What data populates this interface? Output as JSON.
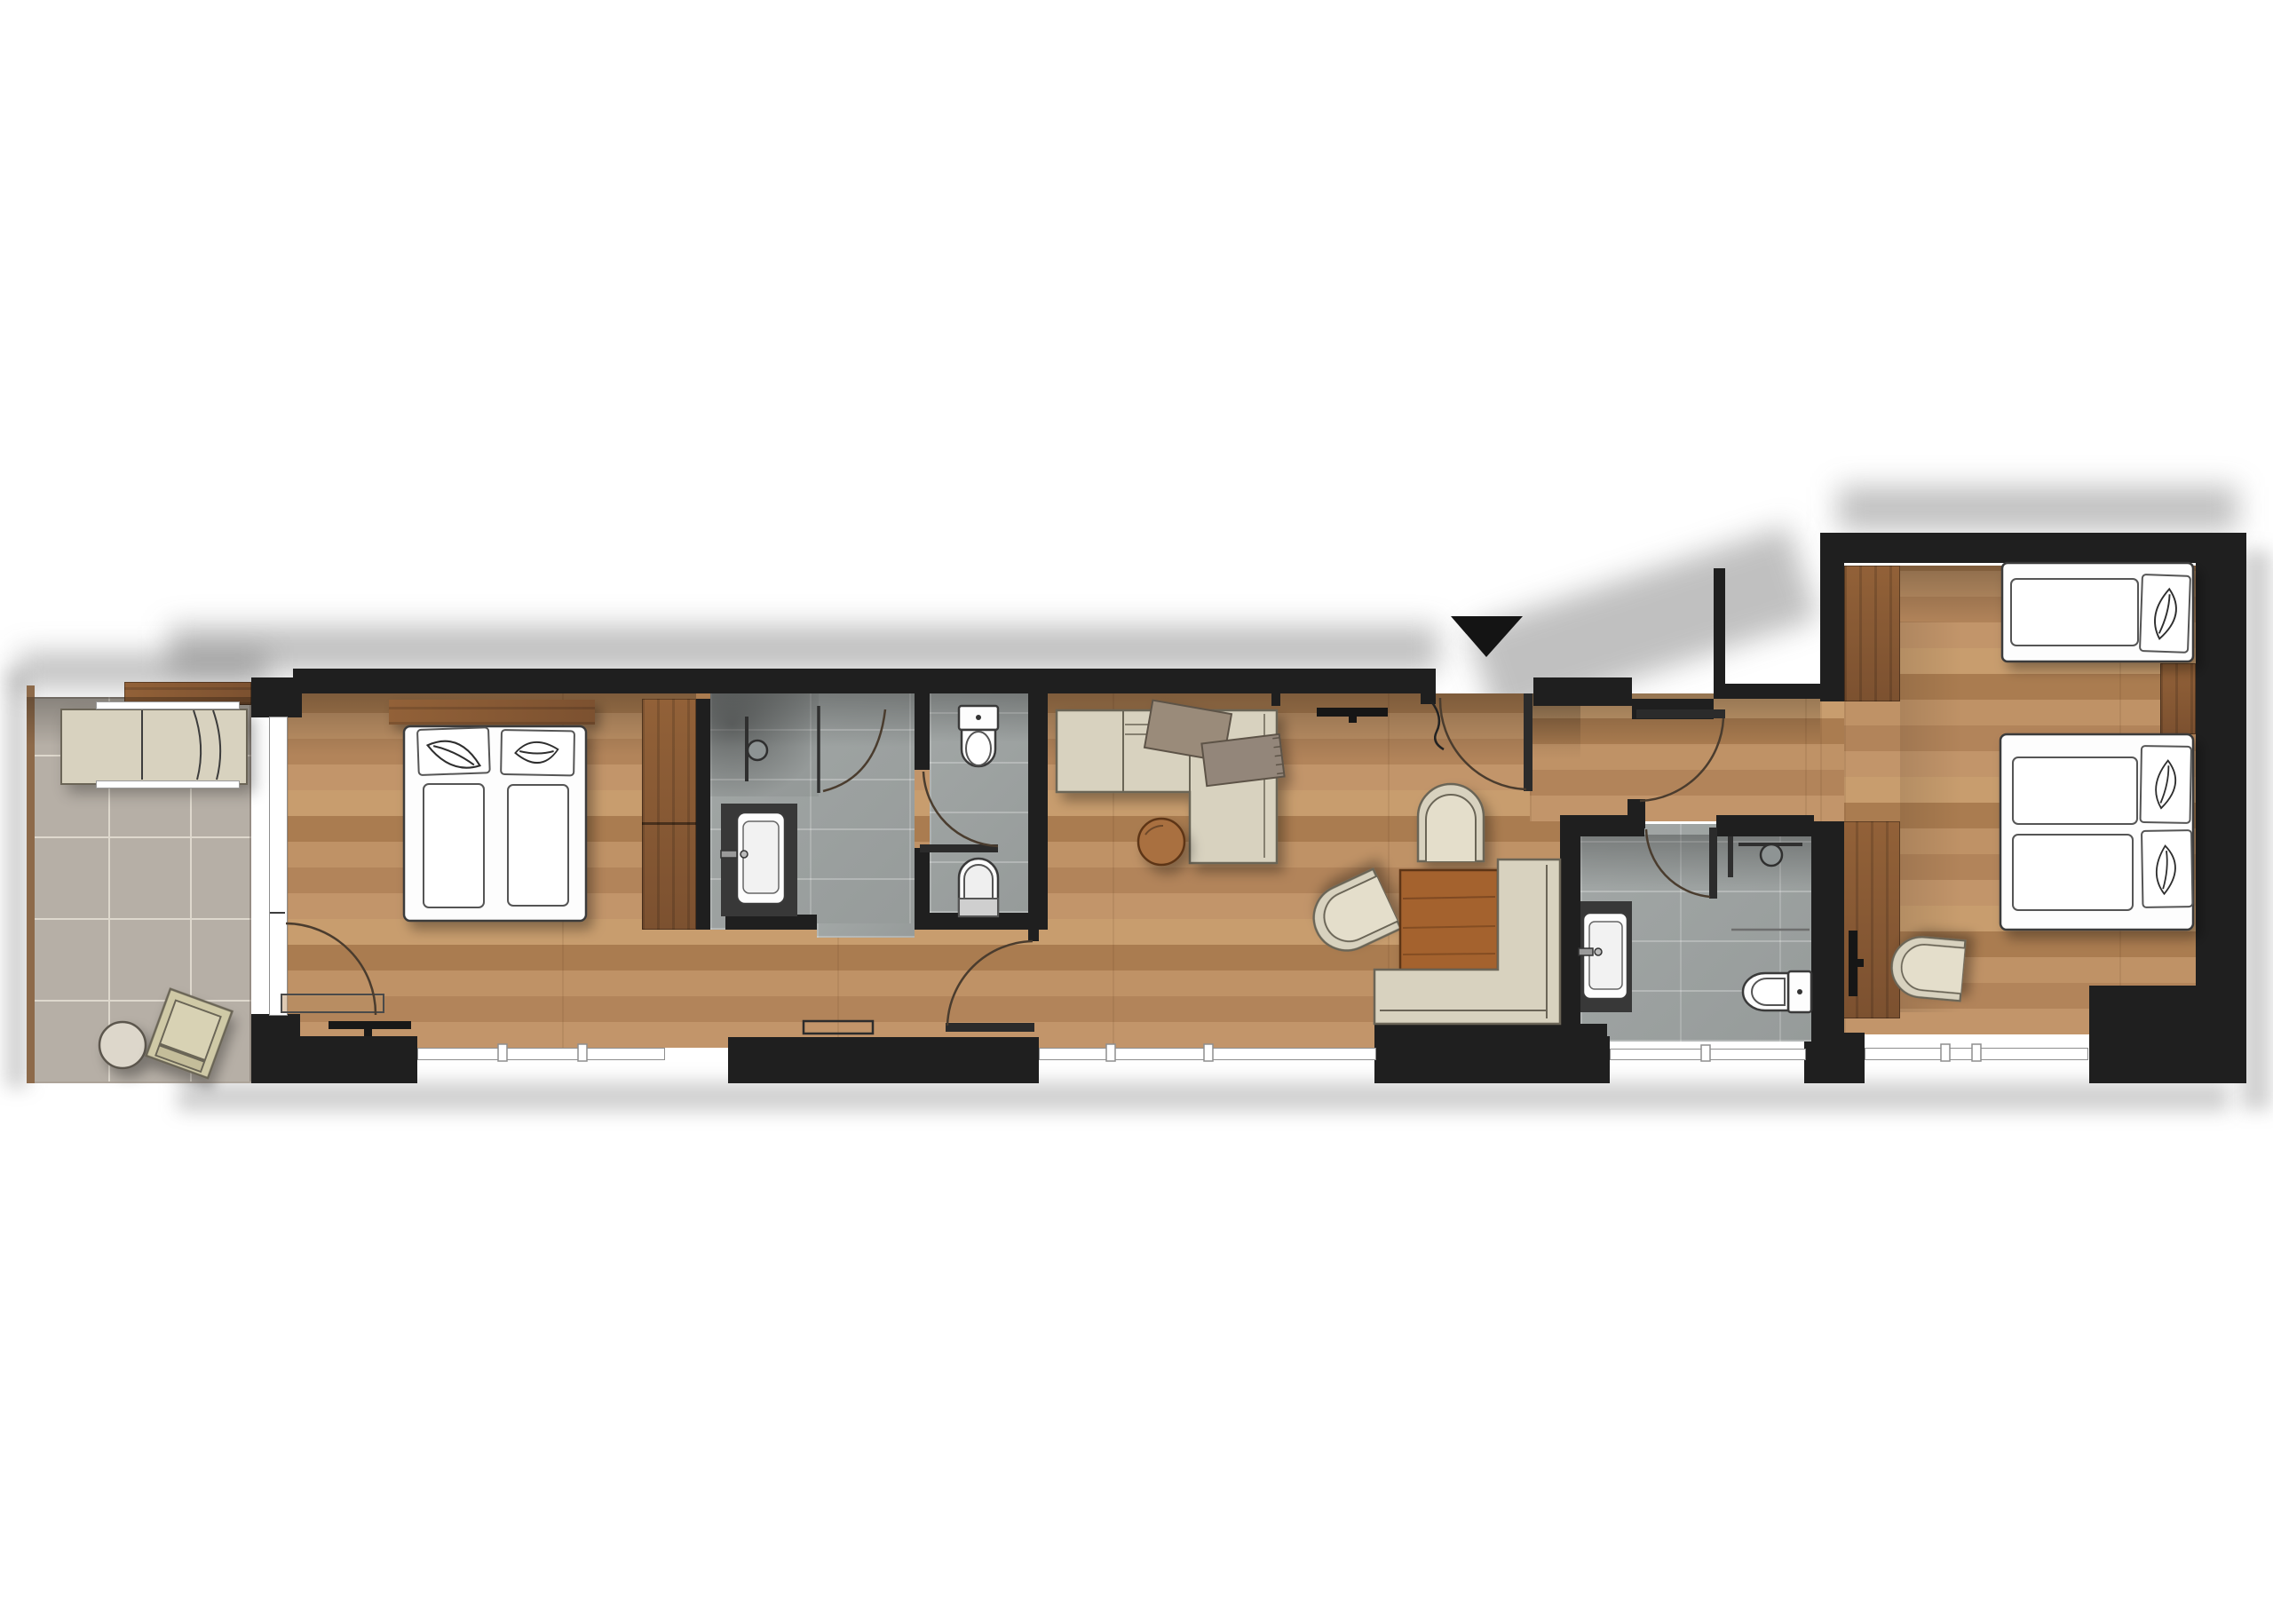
{
  "title": "Hotel suite floor plan (top-down architectural rendering, no text labels)",
  "colors": {
    "wall": "#1f1f1f",
    "outline": "#3c3c3c",
    "door_arc": "#4a3c2e",
    "wood_floor_a": "#c2956a",
    "wood_floor_b": "#b2845a",
    "wood_floor_c": "#aa7c50",
    "wood_dark_a": "#926138",
    "wood_dark_b": "#7c5130",
    "table_wood": "#a4622e",
    "coffee_table": "#a96f3f",
    "tile_terrace": "#b6afa6",
    "tile_grout": "#ded8cd",
    "tile_bath_a": "#a2a7a6",
    "tile_bath_b": "#969b9a",
    "counter": "#383838",
    "beige": "#d8d2bf",
    "beige_inner": "#e4decb",
    "beige_line": "#6b6557",
    "khaki": "#cfc9a6",
    "taupe": "#9a8b7a",
    "throw": "#93867a",
    "fixture": "#fdfdfd",
    "window_line": "#8e8e8e",
    "marker": "#141414"
  },
  "annotations": {
    "entrance_marker": "black triangle pointing down above entrance door"
  },
  "rooms": [
    {
      "name": "terrace",
      "floor": "stone-tile",
      "furniture": [
        "sun-lounger",
        "round-side-table",
        "lounge-chair"
      ],
      "edges": [
        "wood-deck-strip-top",
        "wood-edge-left"
      ]
    },
    {
      "name": "bedroom-1",
      "floor": "wood-plank",
      "furniture": [
        "double-bed",
        "pillow-left",
        "pillow-right",
        "headboard-panel",
        "wardrobe",
        "wall-tv",
        "low-console"
      ],
      "windows": [
        "south-window-band",
        "west-glass-door"
      ],
      "doors": [
        "terrace-glass-door-arc"
      ]
    },
    {
      "name": "bathroom-1",
      "floor": "gray-tile",
      "fixtures": [
        "shower-head",
        "glass-partition",
        "vanity-counter",
        "basin"
      ],
      "doors": [
        "swing-door-arc"
      ]
    },
    {
      "name": "wc",
      "floor": "gray-tile",
      "fixtures": [
        "toilet-with-cistern",
        "bidet"
      ],
      "doors": [
        "swing-door-arc"
      ]
    },
    {
      "name": "living-room",
      "floor": "wood-plank",
      "furniture": [
        "corner-sofa-with-chaise",
        "cushion",
        "throw-blanket",
        "round-coffee-table",
        "wall-tv",
        "floor-lamp",
        "barrel-chair-north",
        "barrel-chair-west",
        "square-dining-table",
        "l-shaped-bench",
        "wall-console"
      ],
      "windows": [
        "south-window-band"
      ],
      "doors": [
        "passage-door-arc"
      ]
    },
    {
      "name": "entrance-hall",
      "floor": "wood-plank",
      "doors": [
        "entrance-door-arc",
        "corridor-door-arc"
      ]
    },
    {
      "name": "bathroom-2",
      "floor": "gray-tile",
      "fixtures": [
        "shower-head",
        "glass-screen",
        "shower-floor-line",
        "vanity-counter",
        "basin",
        "toilet"
      ],
      "windows": [
        "south-window-band"
      ],
      "doors": [
        "swing-door-arc"
      ]
    },
    {
      "name": "bedroom-2",
      "floor": "wood-plank",
      "furniture": [
        "single-bed",
        "double-bed",
        "pillows-with-leaf-sketch",
        "wardrobe-upper",
        "wardrobe-lower",
        "wall-tv",
        "angled-side-chair",
        "wood-panel-between-beds"
      ],
      "windows": [
        "south-window-band"
      ]
    }
  ],
  "door_count": 7,
  "window_band_count": 5
}
